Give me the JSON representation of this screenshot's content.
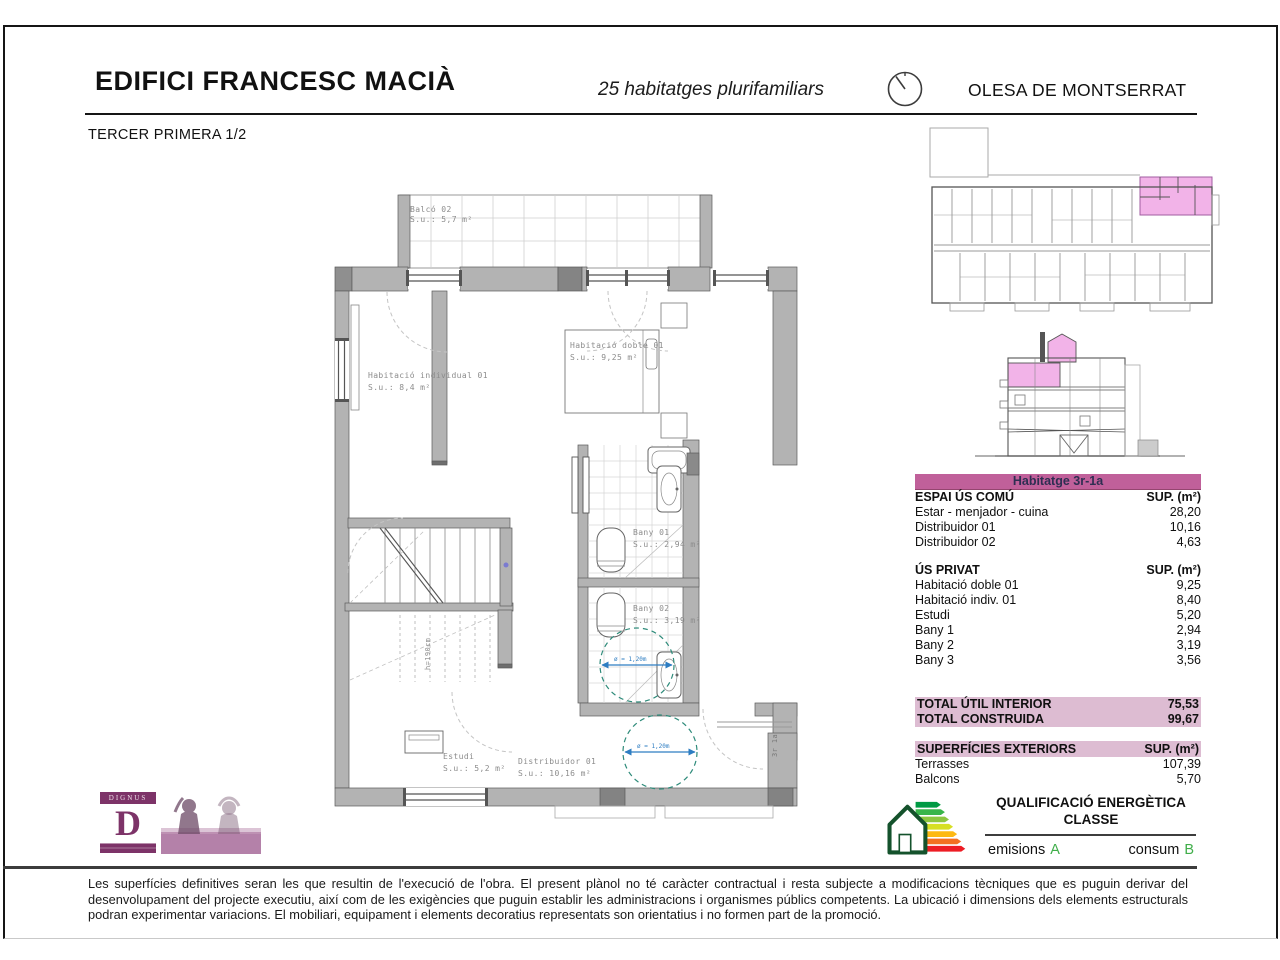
{
  "header": {
    "title": "EDIFICI FRANCESC MACIÀ",
    "subtitle": "25 habitatges plurifamiliars",
    "location": "OLESA DE MONTSERRAT",
    "sheet_label": "TERCER PRIMERA 1/2"
  },
  "plan": {
    "rooms": {
      "balco": {
        "name": "Balcó 02",
        "area": "S.u.: 5,7 m²"
      },
      "hab_individual": {
        "name": "Habitació individual 01",
        "area": "S.u.: 8,4 m²"
      },
      "hab_doble": {
        "name": "Habitació doble 01",
        "area": "S.u.: 9,25 m²"
      },
      "bany01": {
        "name": "Bany 01",
        "area": "S.u.: 2,94 m²"
      },
      "bany02": {
        "name": "Bany 02",
        "area": "S.u.: 3,19 m²"
      },
      "estudi": {
        "name": "Estudi",
        "area": "S.u.: 5,2 m²"
      },
      "distribuidor": {
        "name": "Distribuidor 01",
        "area": "S.u.: 10,16 m²"
      }
    },
    "annotations": {
      "stair_height": "h=190cm",
      "unit_door": "3r 1a",
      "turning_circle": "ø = 1,20m"
    }
  },
  "table": {
    "title": "Habitatge 3r-1a",
    "col_header": "SUP. (m²)",
    "espai_us_comu": {
      "header": "ESPAI ÚS COMÚ",
      "rows": [
        {
          "label": "Estar - menjador - cuina",
          "value": "28,20"
        },
        {
          "label": "Distribuidor 01",
          "value": "10,16"
        },
        {
          "label": "Distribuidor 02",
          "value": "4,63"
        }
      ]
    },
    "us_privat": {
      "header": "ÚS PRIVAT",
      "rows": [
        {
          "label": "Habitació doble 01",
          "value": "9,25"
        },
        {
          "label": "Habitació indiv. 01",
          "value": "8,40"
        },
        {
          "label": "Estudi",
          "value": "5,20"
        },
        {
          "label": "Bany 1",
          "value": "2,94"
        },
        {
          "label": "Bany 2",
          "value": "3,19"
        },
        {
          "label": "Bany 3",
          "value": "3,56"
        }
      ]
    },
    "totals": [
      {
        "label": "TOTAL ÚTIL INTERIOR",
        "value": "75,53"
      },
      {
        "label": "TOTAL CONSTRUIDA",
        "value": "99,67"
      }
    ],
    "exteriors": {
      "header": "SUPERFÍCIES EXTERIORS",
      "rows": [
        {
          "label": "Terrasses",
          "value": "107,39"
        },
        {
          "label": "Balcons",
          "value": "5,70"
        }
      ]
    },
    "colors": {
      "title_band": "#c0609a",
      "light_band": "#ddbcd2"
    }
  },
  "keyplan": {
    "highlight_color": "#f2b3e8"
  },
  "energy": {
    "title_line1": "QUALIFICACIÓ ENERGÈTICA",
    "title_line2": "CLASSE",
    "emissions_label": "emisions",
    "emissions_value": "A",
    "consumption_label": "consum",
    "consumption_value": "B",
    "value_color": "#3fae49"
  },
  "logo": {
    "brand": "DIGNUS",
    "letter": "D"
  },
  "footer": {
    "disclaimer": "Les superfícies definitives seran les que resultin de l'execució de l'obra. El present plànol no té caràcter contractual i resta subjecte a modificacions tècniques que es puguin derivar del desenvolupament del projecte executiu, així com de les exigències que puguin establir les administracions i organismes públics competents. La ubicació i dimensions dels elements estructurals podran experimentar variacions.  El mobiliari, equipament i elements decoratius representats son orientatius i no formen part de la promoció."
  }
}
